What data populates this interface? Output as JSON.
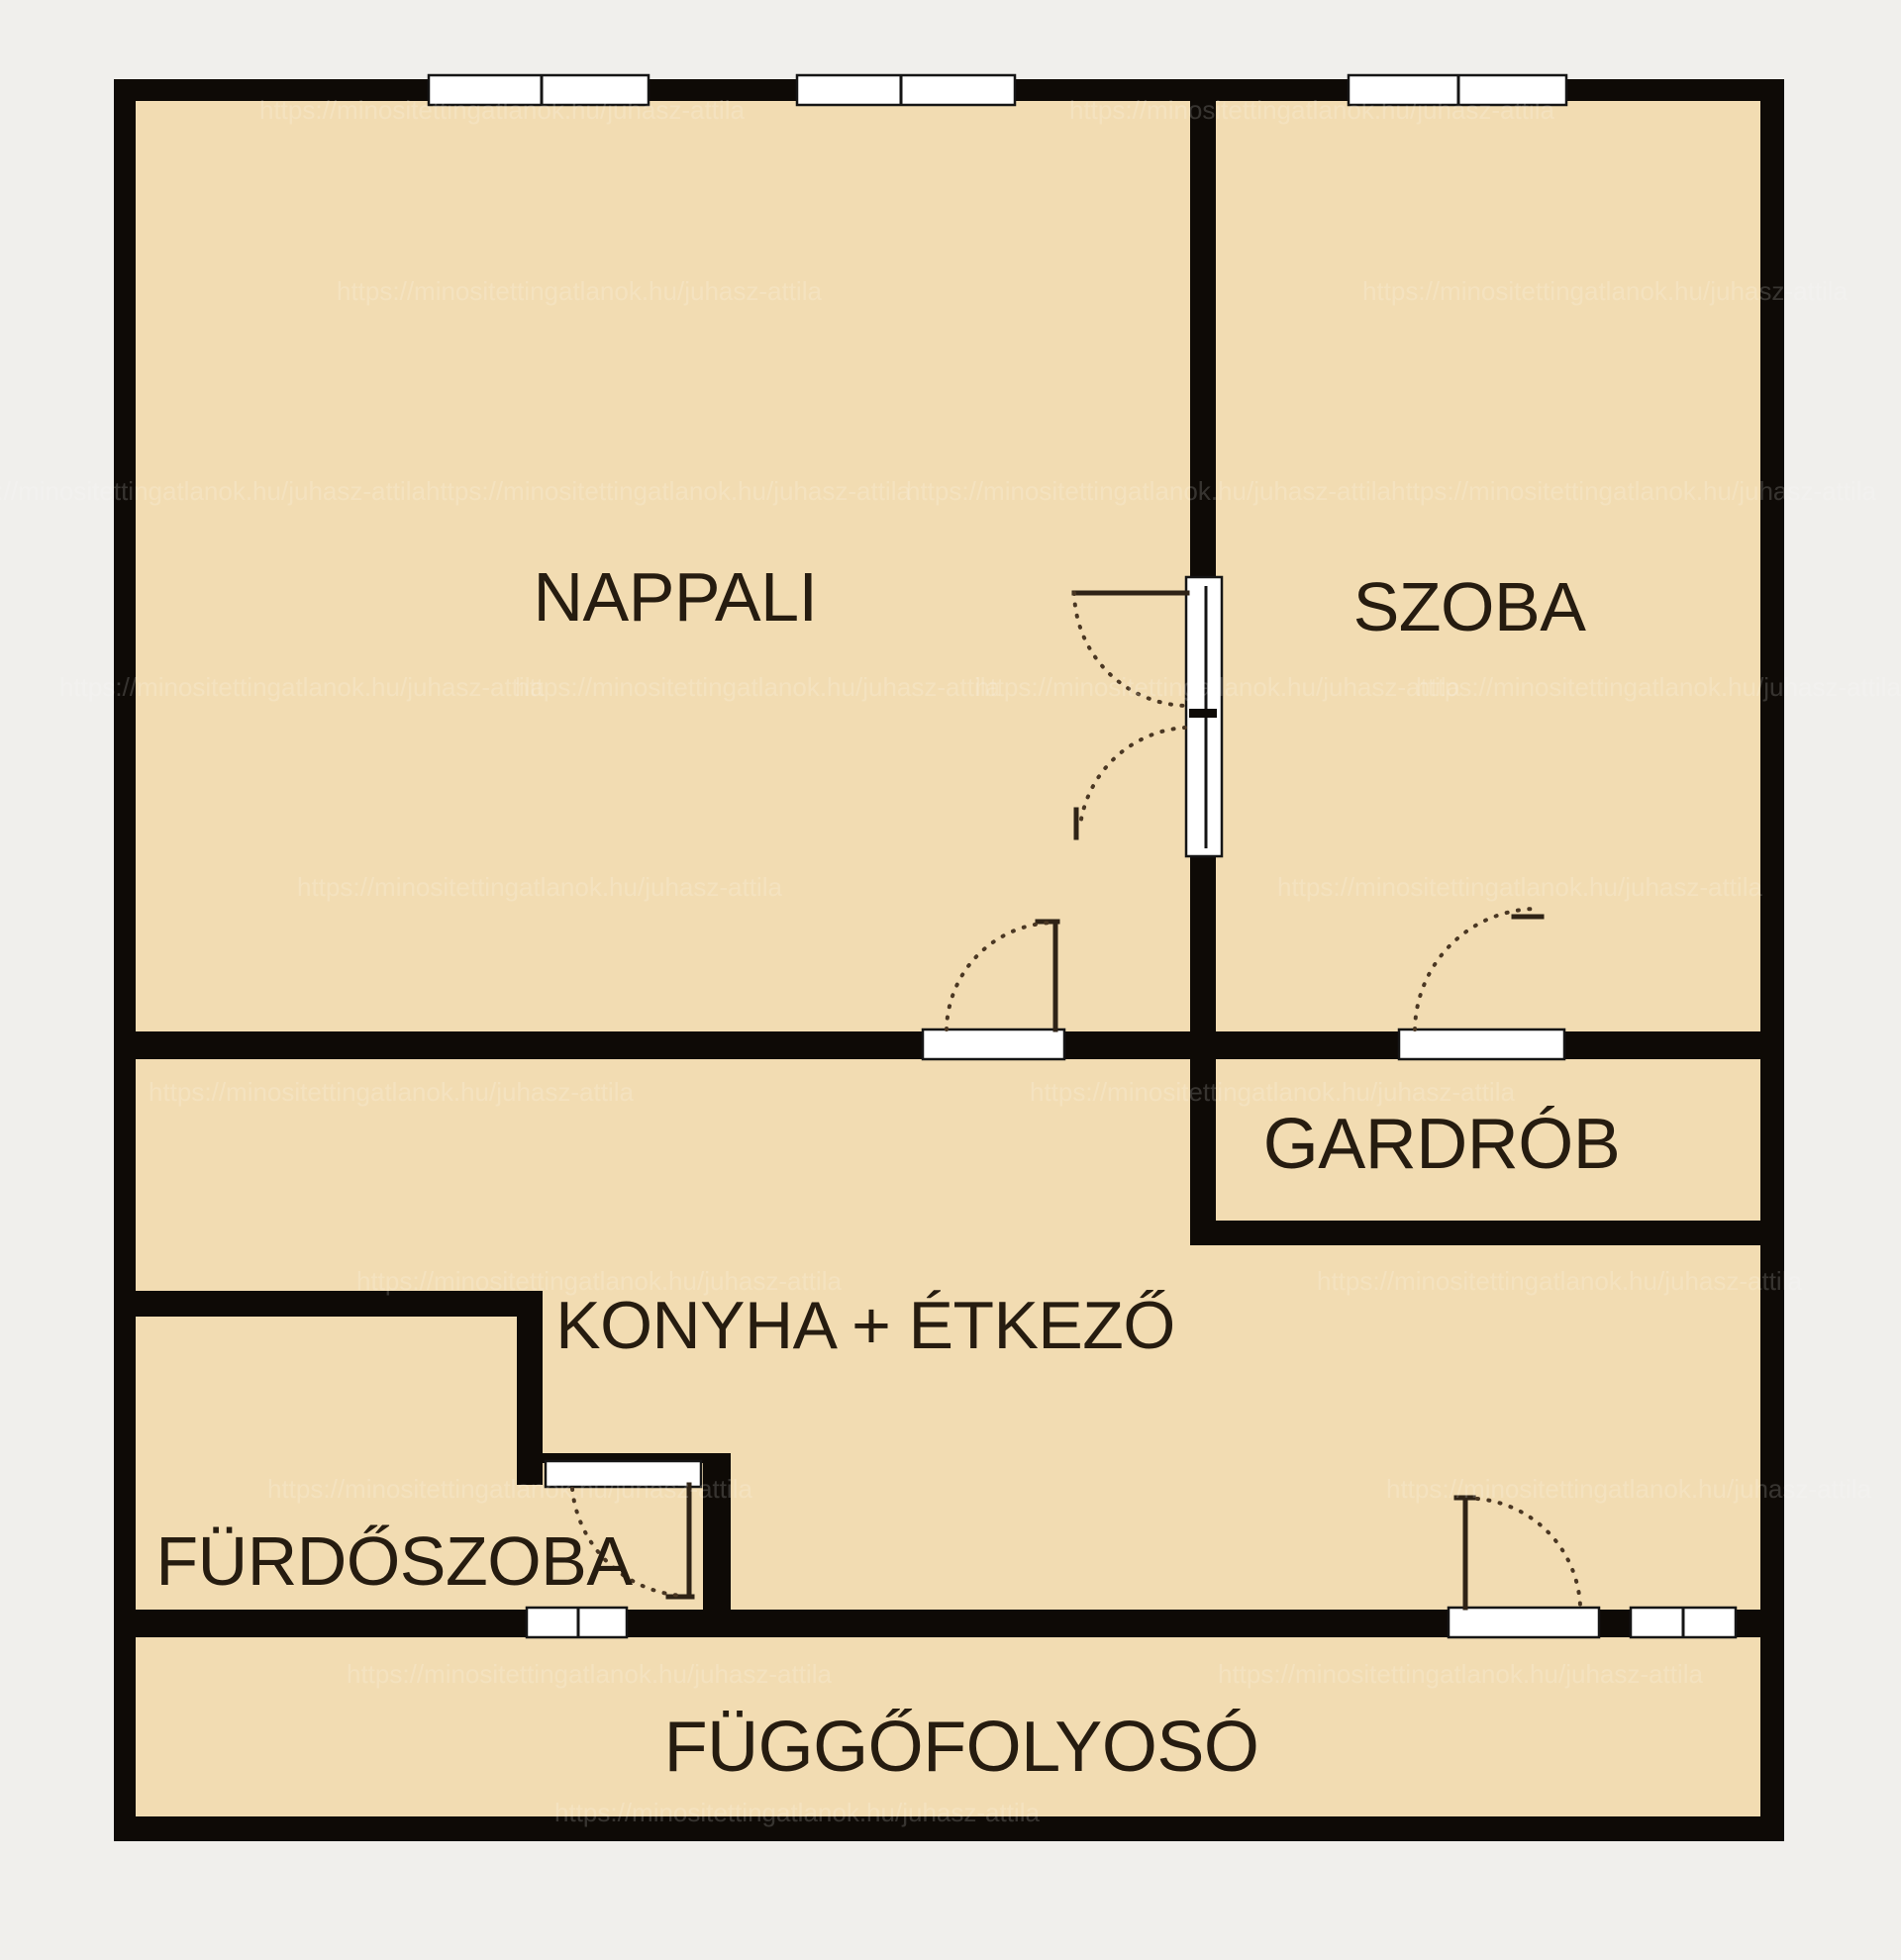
{
  "floorplan": {
    "background_color": "#f0efec",
    "floor_color": "#f2dcb2",
    "wall_color": "#0e0a06",
    "label_color": "#261c10",
    "window_color": "#ffffff",
    "door_arc_color": "#4a3723",
    "watermark_text": "https://minositettingatlanok.hu/juhasz-attila",
    "rooms": [
      {
        "name": "NAPPALI"
      },
      {
        "name": "SZOBA"
      },
      {
        "name": "GARDRÓB"
      },
      {
        "name": "KONYHA + ÉTKEZŐ"
      },
      {
        "name": "FÜRDŐSZOBA"
      },
      {
        "name": "FÜGGŐFOLYOSÓ"
      }
    ]
  }
}
